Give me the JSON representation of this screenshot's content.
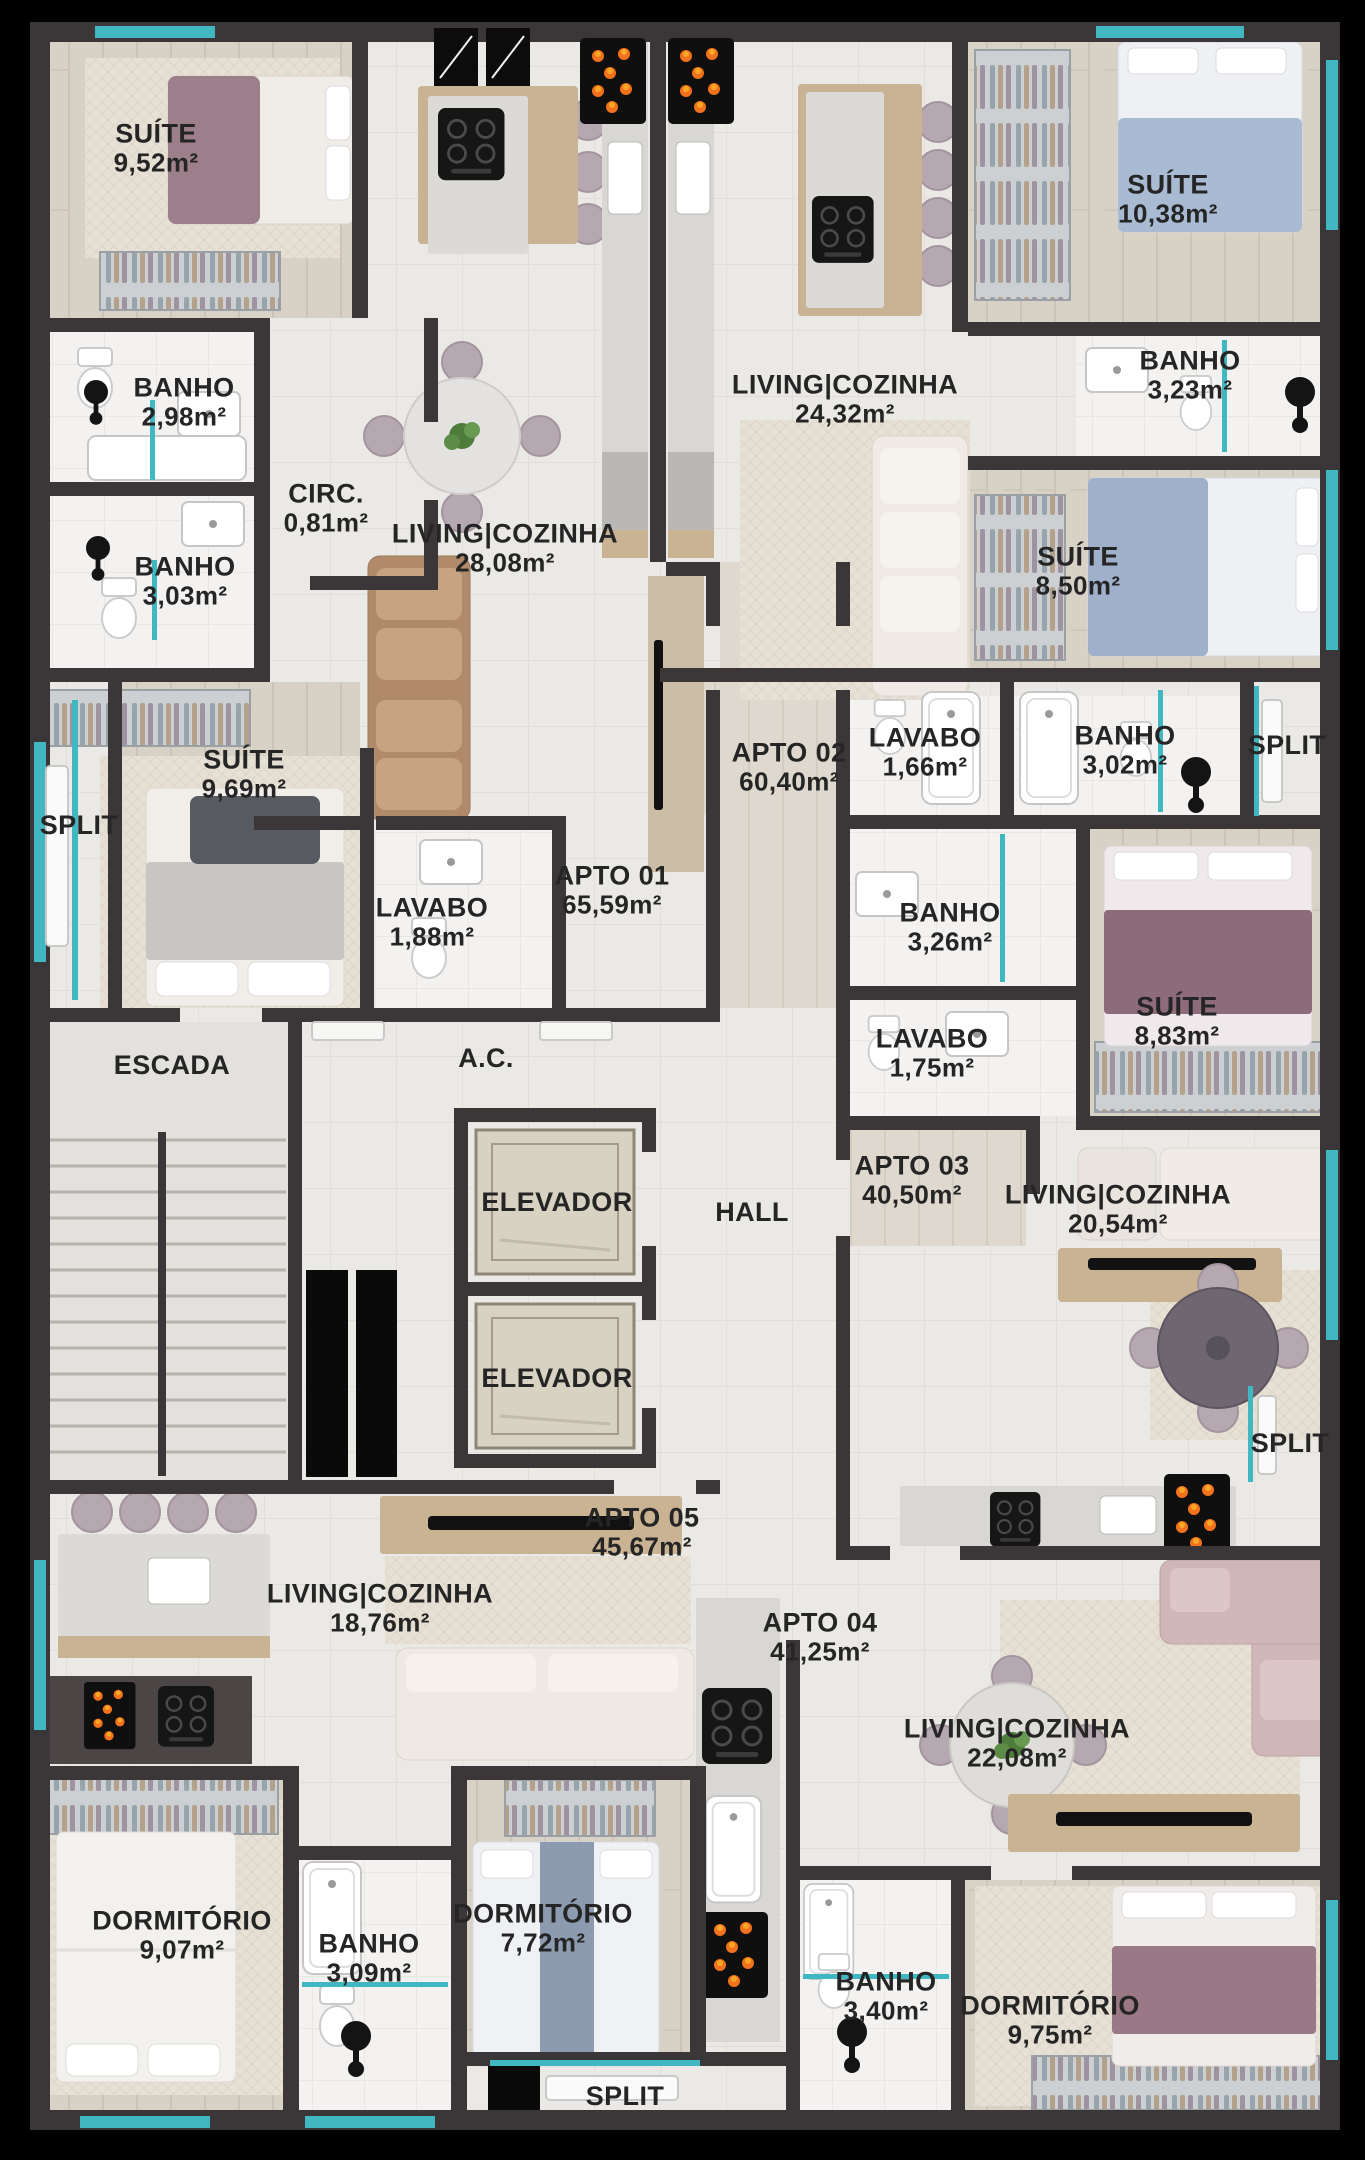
{
  "plan": {
    "title": "Planta do pavimento - 5 apartamentos",
    "colors": {
      "background": "#000000",
      "wall": "#3b3738",
      "floor": "#ebe9e5",
      "floorWood": "#d8d1c6",
      "bath": "#f3f2f0",
      "glass": "#41b7c1",
      "flame": "#f2711c",
      "label": "#252525"
    },
    "labels": [
      {
        "id": "suite-952",
        "title": "SUÍTE",
        "area": "9,52m²",
        "x": 156,
        "y": 148
      },
      {
        "id": "banho-298",
        "title": "BANHO",
        "area": "2,98m²",
        "x": 184,
        "y": 402
      },
      {
        "id": "circ-081",
        "title": "CIRC.",
        "area": "0,81m²",
        "x": 326,
        "y": 508
      },
      {
        "id": "banho-303",
        "title": "BANHO",
        "area": "3,03m²",
        "x": 185,
        "y": 581
      },
      {
        "id": "living-2808",
        "title": "LIVING|COZINHA",
        "area": "28,08m²",
        "x": 505,
        "y": 548
      },
      {
        "id": "living-2432",
        "title": "LIVING|COZINHA",
        "area": "24,32m²",
        "x": 845,
        "y": 399
      },
      {
        "id": "suite-1038",
        "title": "SUÍTE",
        "area": "10,38m²",
        "x": 1168,
        "y": 199
      },
      {
        "id": "banho-323",
        "title": "BANHO",
        "area": "3,23m²",
        "x": 1190,
        "y": 375
      },
      {
        "id": "suite-850",
        "title": "SUÍTE",
        "area": "8,50m²",
        "x": 1078,
        "y": 571
      },
      {
        "id": "lavabo-166",
        "title": "LAVABO",
        "area": "1,66m²",
        "x": 925,
        "y": 752
      },
      {
        "id": "banho-302",
        "title": "BANHO",
        "area": "3,02m²",
        "x": 1125,
        "y": 750
      },
      {
        "id": "split-ne",
        "title": "SPLIT",
        "x": 1287,
        "y": 745
      },
      {
        "id": "apto-02",
        "title": "APTO 02",
        "area": "60,40m²",
        "x": 789,
        "y": 767
      },
      {
        "id": "suite-969",
        "title": "SUÍTE",
        "area": "9,69m²",
        "x": 244,
        "y": 774
      },
      {
        "id": "split-w",
        "title": "SPLIT",
        "x": 79,
        "y": 825
      },
      {
        "id": "lavabo-188",
        "title": "LAVABO",
        "area": "1,88m²",
        "x": 432,
        "y": 922
      },
      {
        "id": "apto-01",
        "title": "APTO 01",
        "area": "65,59m²",
        "x": 612,
        "y": 890
      },
      {
        "id": "banho-326",
        "title": "BANHO",
        "area": "3,26m²",
        "x": 950,
        "y": 927
      },
      {
        "id": "lavabo-175",
        "title": "LAVABO",
        "area": "1,75m²",
        "x": 932,
        "y": 1053
      },
      {
        "id": "suite-883",
        "title": "SUÍTE",
        "area": "8,83m²",
        "x": 1177,
        "y": 1021
      },
      {
        "id": "apto-03",
        "title": "APTO 03",
        "area": "40,50m²",
        "x": 912,
        "y": 1180
      },
      {
        "id": "living-2054",
        "title": "LIVING|COZINHA",
        "area": "20,54m²",
        "x": 1118,
        "y": 1209
      },
      {
        "id": "escada",
        "title": "ESCADA",
        "x": 172,
        "y": 1065
      },
      {
        "id": "ac",
        "title": "A.C.",
        "x": 486,
        "y": 1058
      },
      {
        "id": "elevador-1",
        "title": "ELEVADOR",
        "x": 557,
        "y": 1202
      },
      {
        "id": "hall",
        "title": "HALL",
        "x": 752,
        "y": 1212
      },
      {
        "id": "elevador-2",
        "title": "ELEVADOR",
        "x": 557,
        "y": 1378
      },
      {
        "id": "split-e",
        "title": "SPLIT",
        "x": 1290,
        "y": 1443
      },
      {
        "id": "apto-05",
        "title": "APTO 05",
        "area": "45,67m²",
        "x": 642,
        "y": 1532
      },
      {
        "id": "living-1876",
        "title": "LIVING|COZINHA",
        "area": "18,76m²",
        "x": 380,
        "y": 1608
      },
      {
        "id": "apto-04",
        "title": "APTO 04",
        "area": "41,25m²",
        "x": 820,
        "y": 1637
      },
      {
        "id": "living-2208",
        "title": "LIVING|COZINHA",
        "area": "22,08m²",
        "x": 1017,
        "y": 1743
      },
      {
        "id": "dormitorio-907",
        "title": "DORMITÓRIO",
        "area": "9,07m²",
        "x": 182,
        "y": 1935
      },
      {
        "id": "banho-309",
        "title": "BANHO",
        "area": "3,09m²",
        "x": 369,
        "y": 1958
      },
      {
        "id": "dormitorio-772",
        "title": "DORMITÓRIO",
        "area": "7,72m²",
        "x": 543,
        "y": 1928
      },
      {
        "id": "banho-340",
        "title": "BANHO",
        "area": "3,40m²",
        "x": 886,
        "y": 1996
      },
      {
        "id": "dormitorio-975",
        "title": "DORMITÓRIO",
        "area": "9,75m²",
        "x": 1050,
        "y": 2020
      },
      {
        "id": "split-s",
        "title": "SPLIT",
        "x": 625,
        "y": 2096
      }
    ]
  }
}
